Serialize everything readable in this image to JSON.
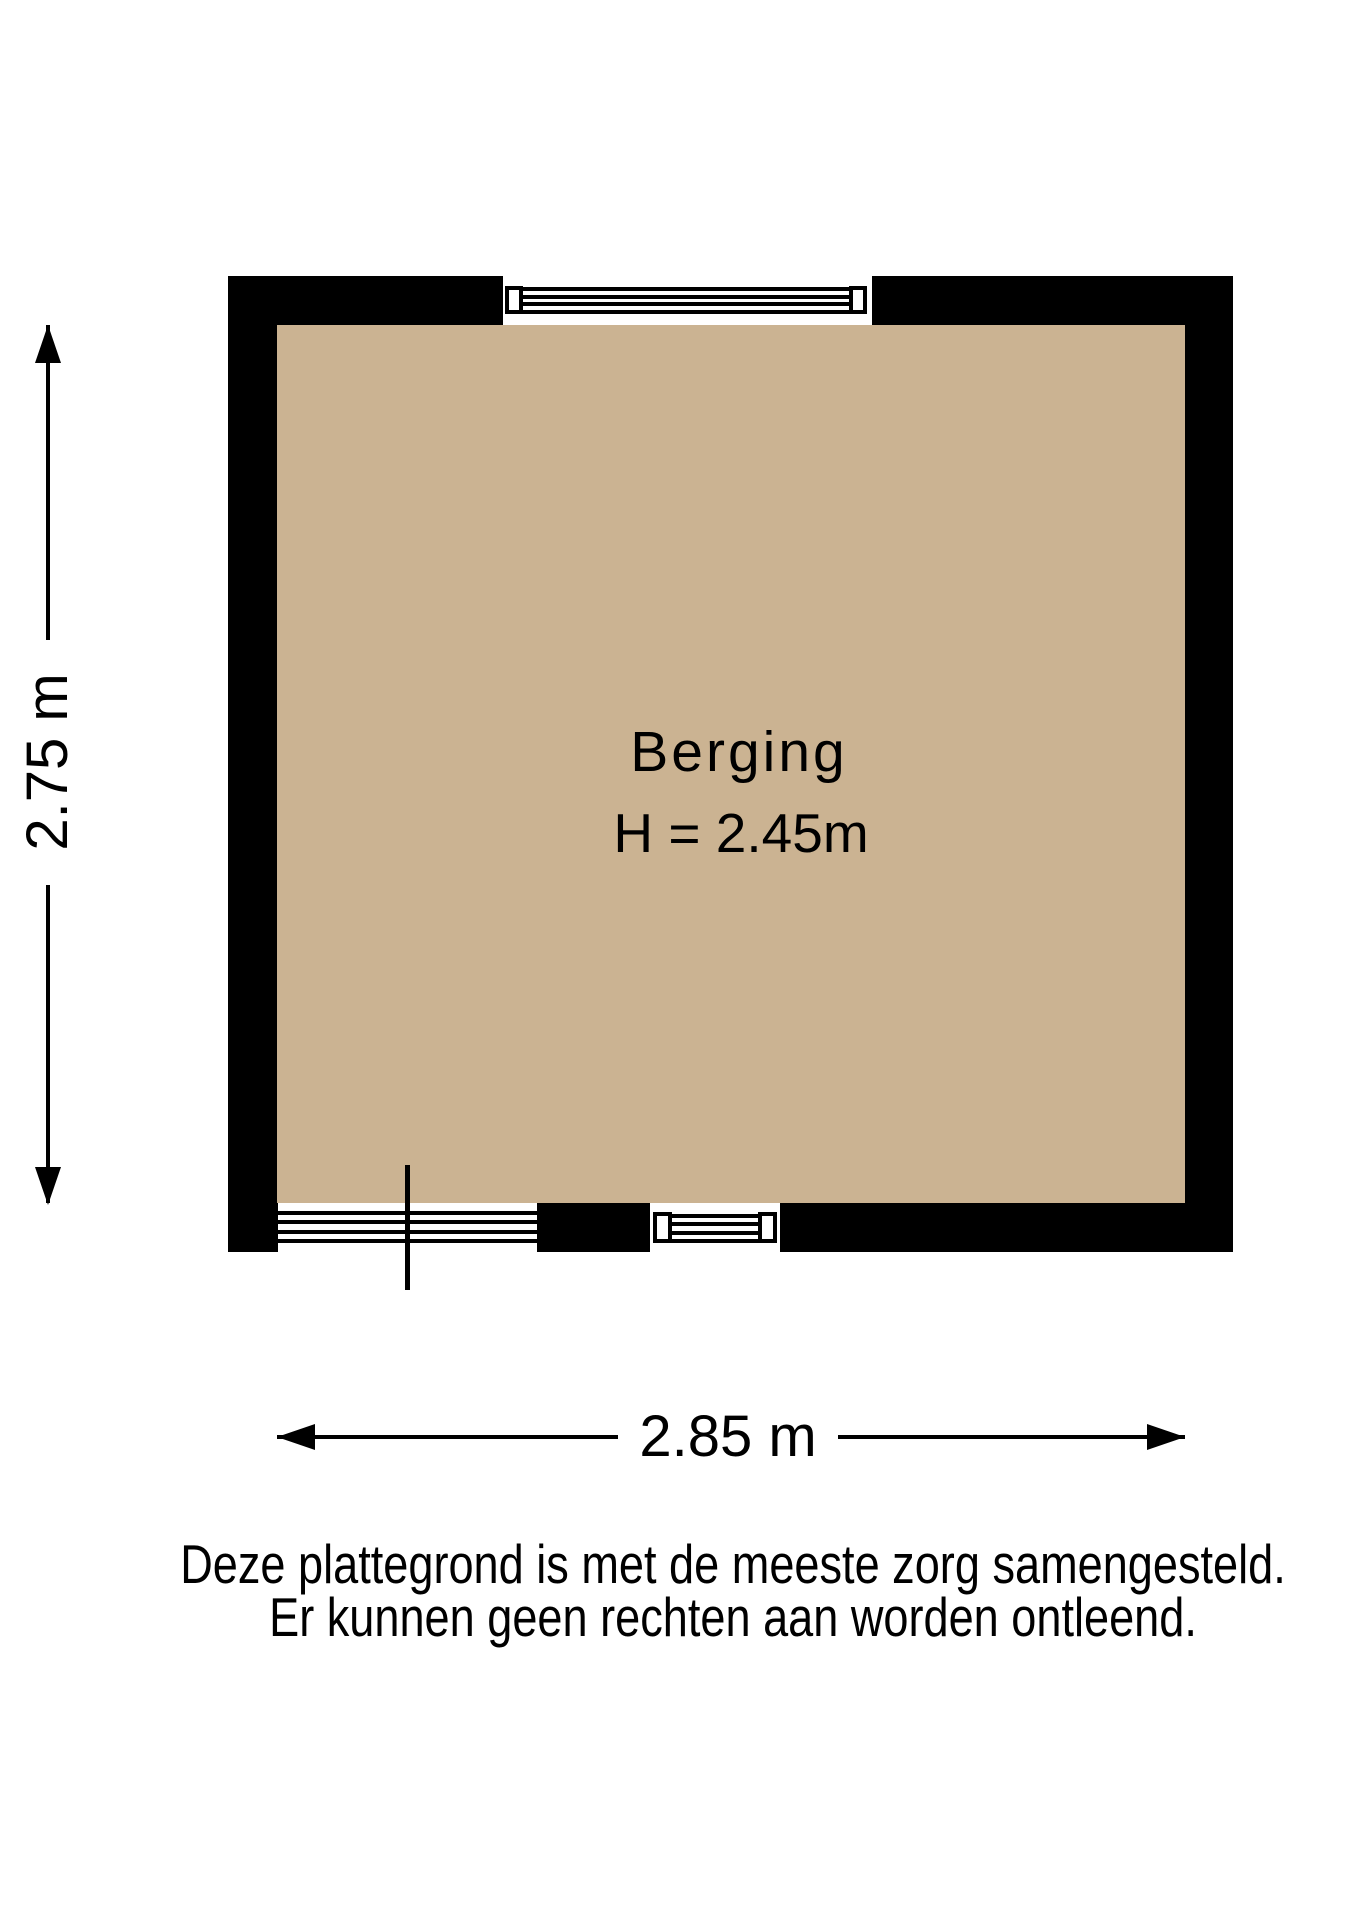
{
  "floorplan": {
    "room_label": "Berging",
    "ceiling_height_label": "H = 2.45m",
    "dimension_vertical_label": "2.75 m",
    "dimension_horizontal_label": "2.85 m",
    "colors": {
      "wall": "#000000",
      "floor": "#cbb392",
      "text": "#000000",
      "background": "#ffffff"
    }
  },
  "disclaimer": {
    "line1": "Deze plattegrond is met de meeste zorg samengesteld.",
    "line2": "Er kunnen geen rechten aan worden ontleend."
  }
}
